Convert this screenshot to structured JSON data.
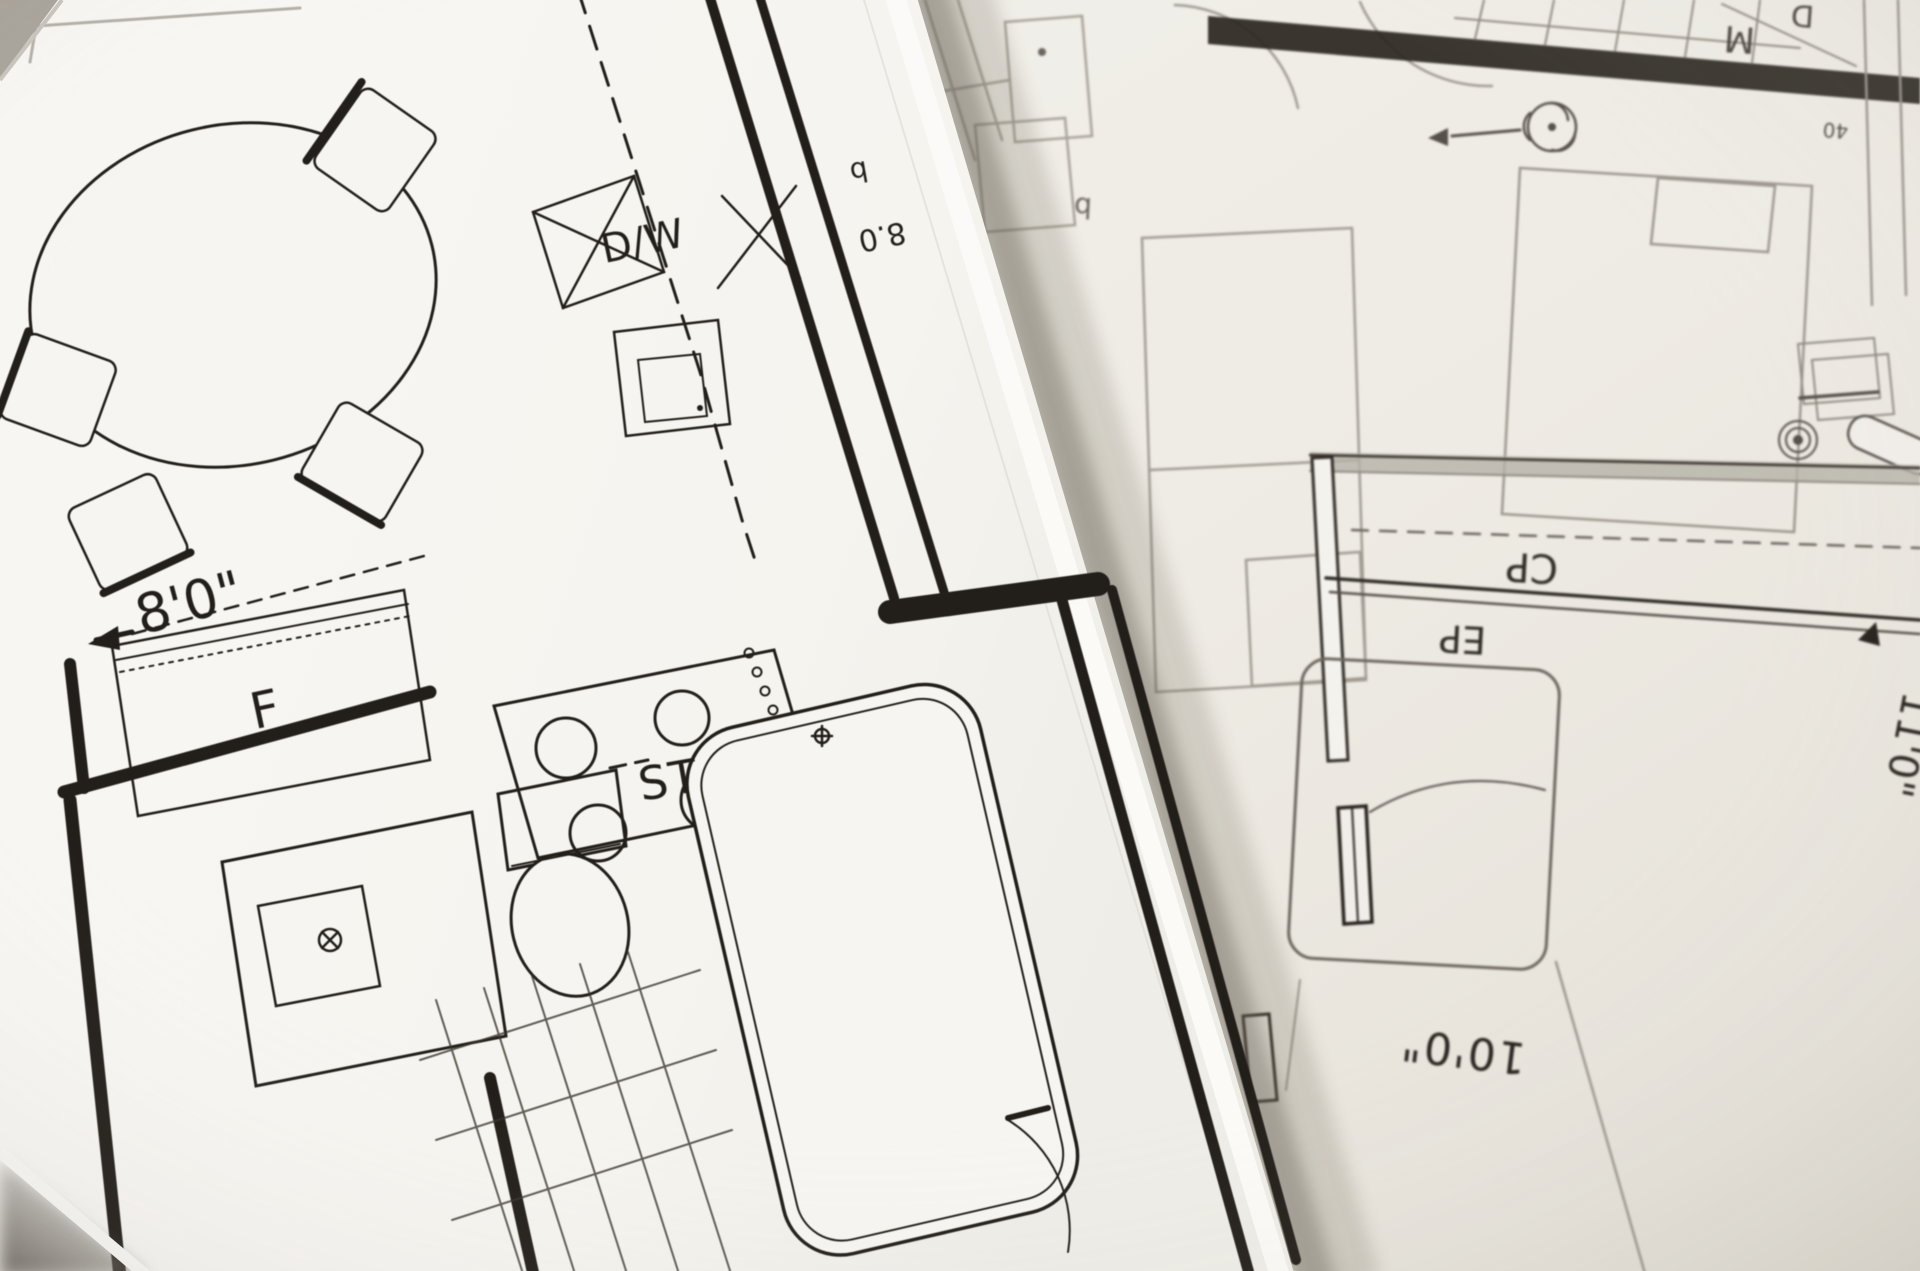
{
  "scene": {
    "type": "photograph",
    "subject": "Two overlapping architectural floor-plan blueprint sheets, top sheet tilted, bottom sheet rotated upside-down"
  },
  "colors": {
    "paper_top": "#f8f6f2",
    "paper_under": "#efece6",
    "ink_dark": "#221e19",
    "ink_gray": "#6b665e",
    "ink_light": "#a09b92",
    "shadow": "#8d8880"
  },
  "top_sheet": {
    "labels": {
      "dishwasher": "D/W",
      "stove": "ST",
      "fixture_f": "F",
      "dimension_8ft": "8'0\"",
      "dimension_8_0": "8.0",
      "tag_b1": "b"
    }
  },
  "bottom_sheet": {
    "labels": {
      "closet": "CP",
      "ep": "EP",
      "room_m": "M",
      "room_d": "D",
      "tag_b2": "b",
      "dimension_10ft": "10'0\"",
      "dimension_11ft": "11'0\"",
      "tag_40": "40"
    }
  }
}
